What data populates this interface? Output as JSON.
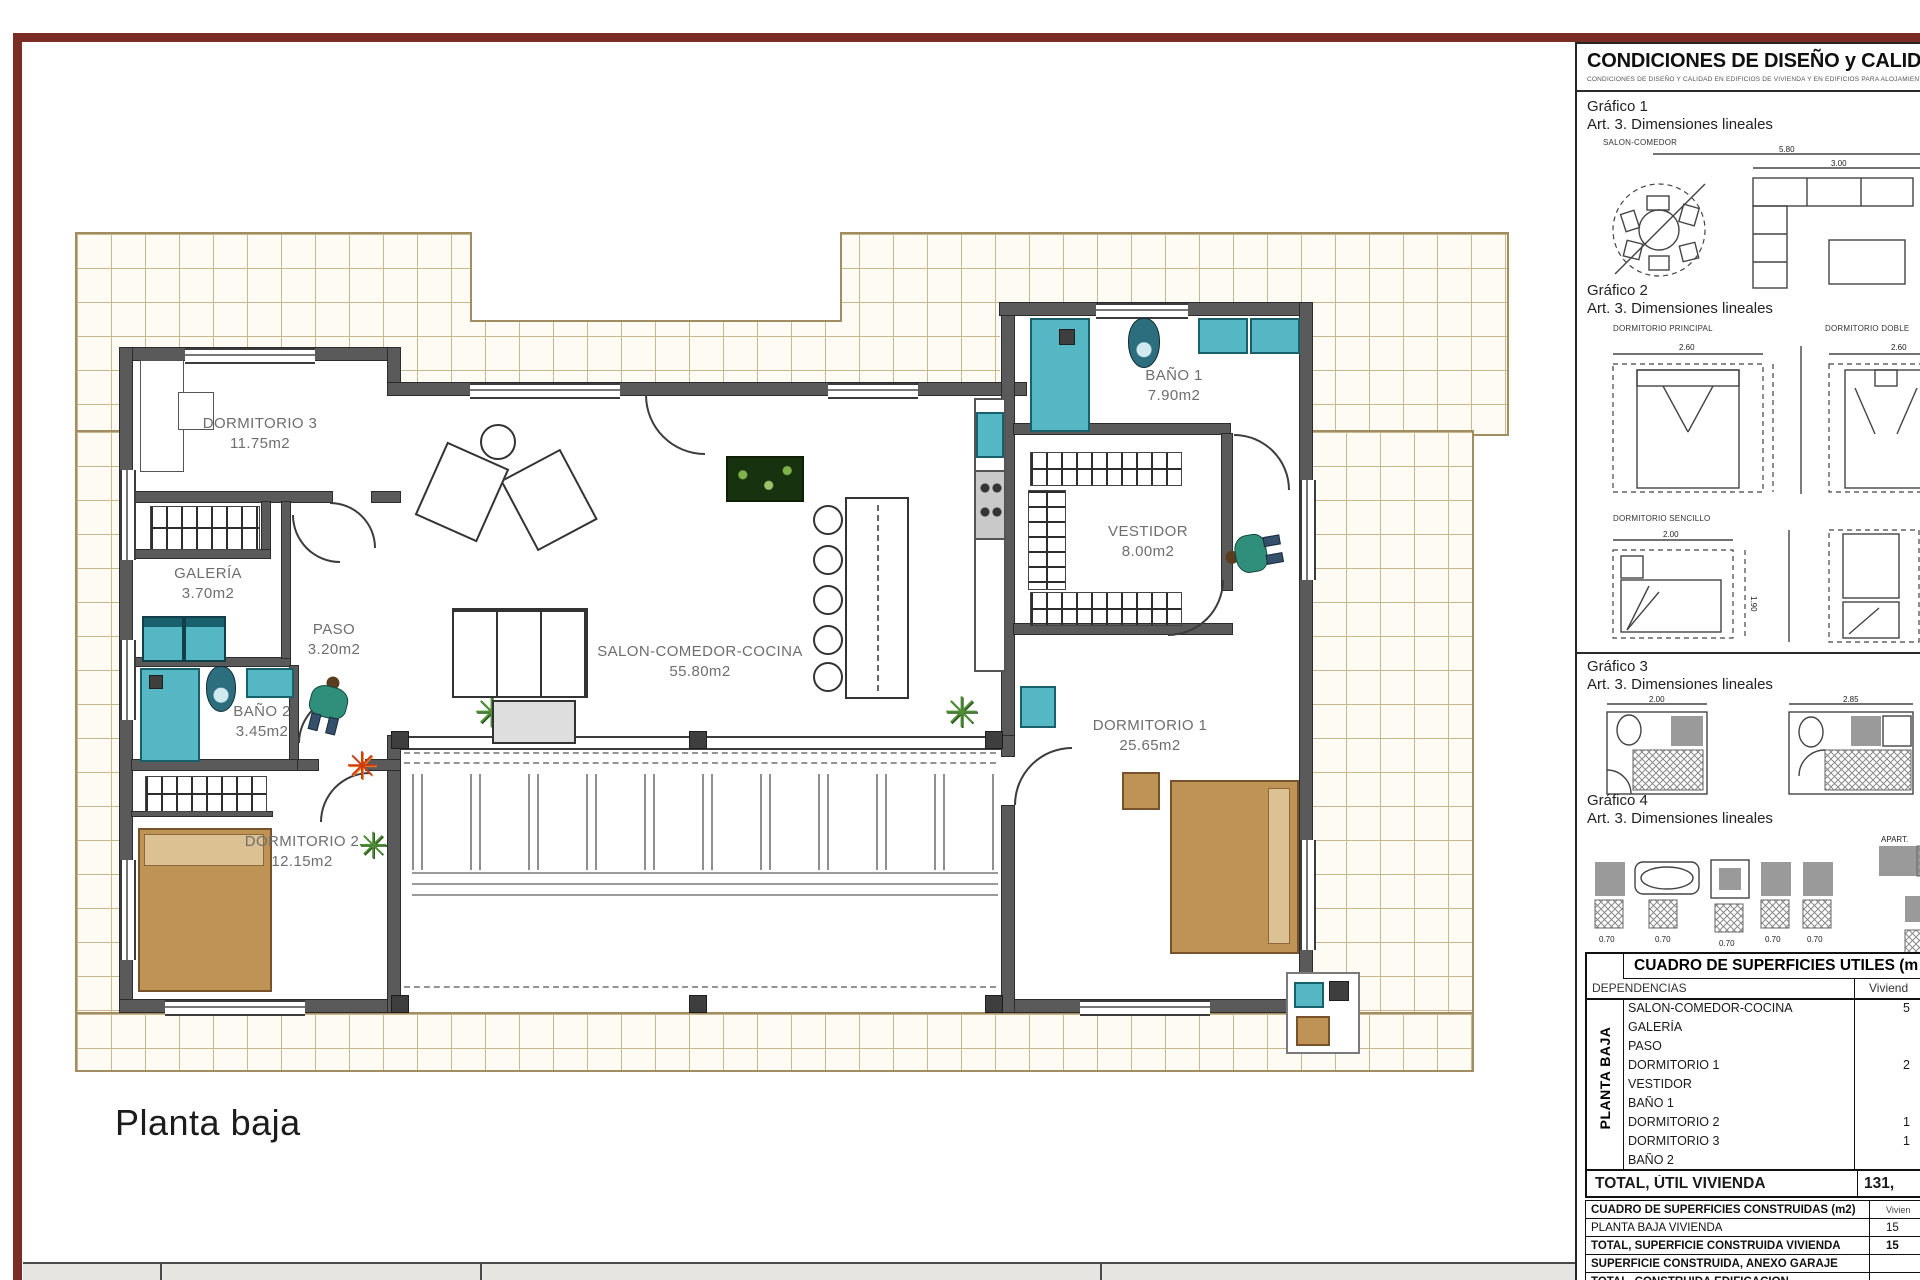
{
  "plan": {
    "floor_label": "Planta baja",
    "rooms": [
      {
        "name": "DORMITORIO 3",
        "area": "11.75m2"
      },
      {
        "name": "GALERÍA",
        "area": "3.70m2"
      },
      {
        "name": "PASO",
        "area": "3.20m2"
      },
      {
        "name": "BAÑO 2",
        "area": "3.45m2"
      },
      {
        "name": "DORMITORIO 2",
        "area": "12.15m2"
      },
      {
        "name": "SALON-COMEDOR-COCINA",
        "area": "55.80m2"
      },
      {
        "name": "BAÑO 1",
        "area": "7.90m2"
      },
      {
        "name": "VESTIDOR",
        "area": "8.00m2"
      },
      {
        "name": "DORMITORIO 1",
        "area": "25.65m2"
      }
    ]
  },
  "panel": {
    "title": "CONDICIONES DE DISEÑO y CALIDAD (DC-0",
    "subtitle": "CONDICIONES DE DISEÑO Y CALIDAD EN EDIFICIOS DE VIVIENDA Y EN EDIFICIOS PARA ALOJAMIENTO",
    "sections": [
      {
        "heading": "Gráfico 1",
        "sub": "Art. 3. Dimensiones lineales"
      },
      {
        "heading": "Gráfico 2",
        "sub": "Art. 3. Dimensiones lineales"
      },
      {
        "heading": "Gráfico 3",
        "sub": "Art. 3. Dimensiones lineales"
      },
      {
        "heading": "Gráfico 4",
        "sub": "Art. 3. Dimensiones lineales"
      }
    ],
    "g1": {
      "caption": "SALON-COMEDOR",
      "dim_width": "5.80",
      "dim_sofa": "3.00",
      "dim_depth": "2.60"
    },
    "g2": {
      "label_principal": "DORMITORIO PRINCIPAL",
      "label_doble": "DORMITORIO DOBLE",
      "label_sencillo": "DORMITORIO SENCILLO",
      "dim_principal": "2.60",
      "dim_doble": "2.60",
      "dim_sencillo_w": "2.00",
      "dim_sencillo_h": "1.90",
      "dim_right": "4.15"
    },
    "g3": {
      "dim_left": "2.00",
      "dim_right": "2.85"
    },
    "g4": {
      "dim_unit": "0.70",
      "dim_bar": "0.80",
      "label_apart": "APART.",
      "label_zona_1": "ZONA D",
      "label_zona_2": "ZONA D"
    }
  },
  "tables": {
    "utiles": {
      "title": "CUADRO DE SUPERFICIES UTILES (m",
      "col_rooms": "DEPENDENCIAS",
      "col_value": "Viviend",
      "group": "PLANTA BAJA",
      "rows": [
        {
          "label": "SALON-COMEDOR-COCINA",
          "value": "5"
        },
        {
          "label": "GALERÍA",
          "value": ""
        },
        {
          "label": "PASO",
          "value": ""
        },
        {
          "label": "DORMITORIO 1",
          "value": "2"
        },
        {
          "label": "VESTIDOR",
          "value": ""
        },
        {
          "label": "BAÑO 1",
          "value": ""
        },
        {
          "label": "DORMITORIO 2",
          "value": "1"
        },
        {
          "label": "DORMITORIO 3",
          "value": "1"
        },
        {
          "label": "BAÑO 2",
          "value": ""
        }
      ],
      "total_label": "TOTAL, ÚTIL VIVIENDA",
      "total_value": "131,"
    },
    "construidas": {
      "title": "CUADRO DE SUPERFICIES CONSTRUIDAS (m2)",
      "col_value": "Vivien",
      "rows": [
        {
          "label": "PLANTA BAJA VIVIENDA",
          "value": "15"
        },
        {
          "label": "TOTAL, SUPERFICIE CONSTRUIDA VIVIENDA",
          "value": "15"
        },
        {
          "label": "SUPERFICIE CONSTRUIDA, ANEXO GARAJE",
          "value": ""
        },
        {
          "label": "TOTAL, CONSTRUIDA EDIFICACIÓN",
          "value": ""
        }
      ]
    }
  }
}
